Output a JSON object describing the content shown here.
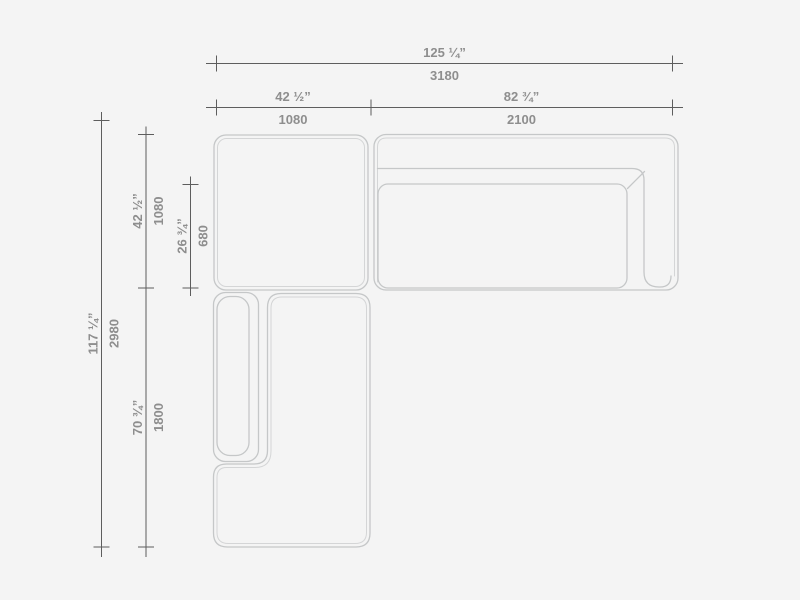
{
  "palette": {
    "background": "#f4f4f4",
    "dimension_line": "#5d5d5d",
    "label_text": "#8e8e8e",
    "furniture_outline": "#c5c7c8",
    "furniture_inner_line": "#d4d5d6"
  },
  "dimensions": {
    "overall_width": {
      "inches": "125 ¼”",
      "mm": "3180"
    },
    "ottoman_width": {
      "inches": "42 ½”",
      "mm": "1080"
    },
    "sofa_width": {
      "inches": "82 ¾”",
      "mm": "2100"
    },
    "overall_depth": {
      "inches": "117 ¼”",
      "mm": "2980"
    },
    "ottoman_depth": {
      "inches": "42 ½”",
      "mm": "1080"
    },
    "seat_depth": {
      "inches": "26 ¾”",
      "mm": "680"
    },
    "chaise_length": {
      "inches": "70 ¾”",
      "mm": "1800"
    }
  }
}
